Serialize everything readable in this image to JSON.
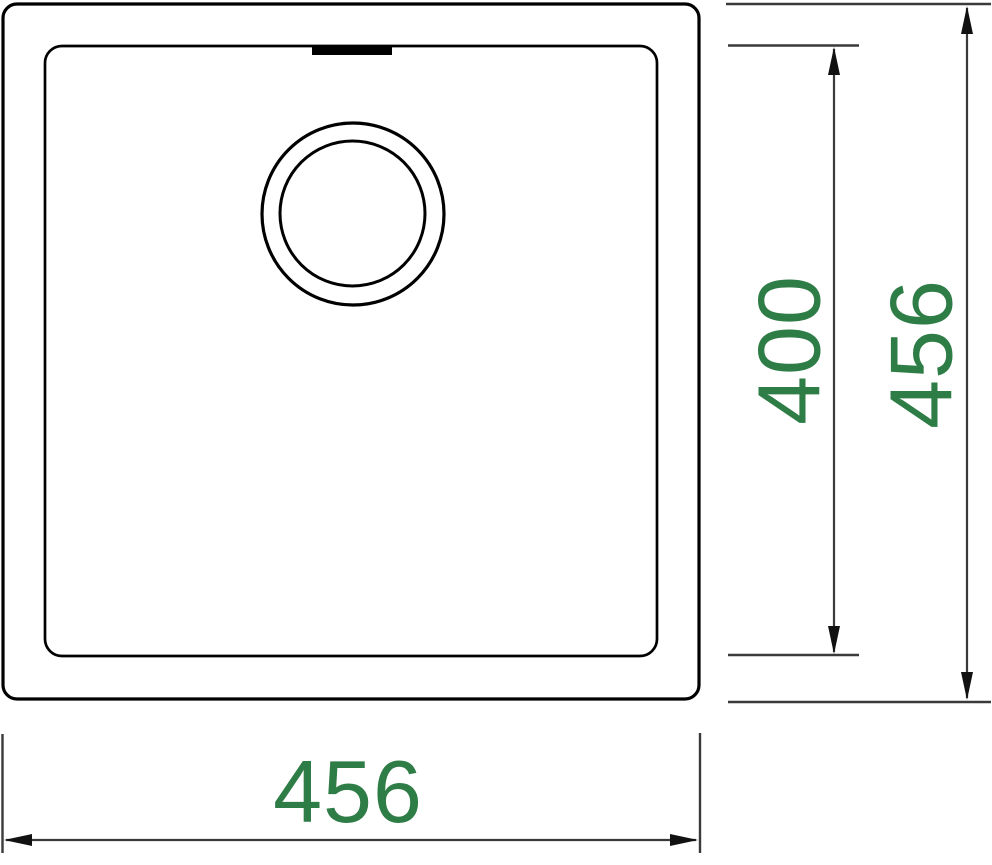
{
  "drawing": {
    "kind": "sink-top-view-technical-drawing",
    "dimensions": {
      "bowl_vertical": {
        "value": "400"
      },
      "outer_vertical": {
        "value": "456"
      },
      "outer_horizontal": {
        "value": "456"
      }
    },
    "colors": {
      "outline": "#000000",
      "dimension_line": "#3a3a3a",
      "arrowhead": "#111111",
      "dimension_text": "#2e7d46",
      "background": "#ffffff"
    }
  }
}
